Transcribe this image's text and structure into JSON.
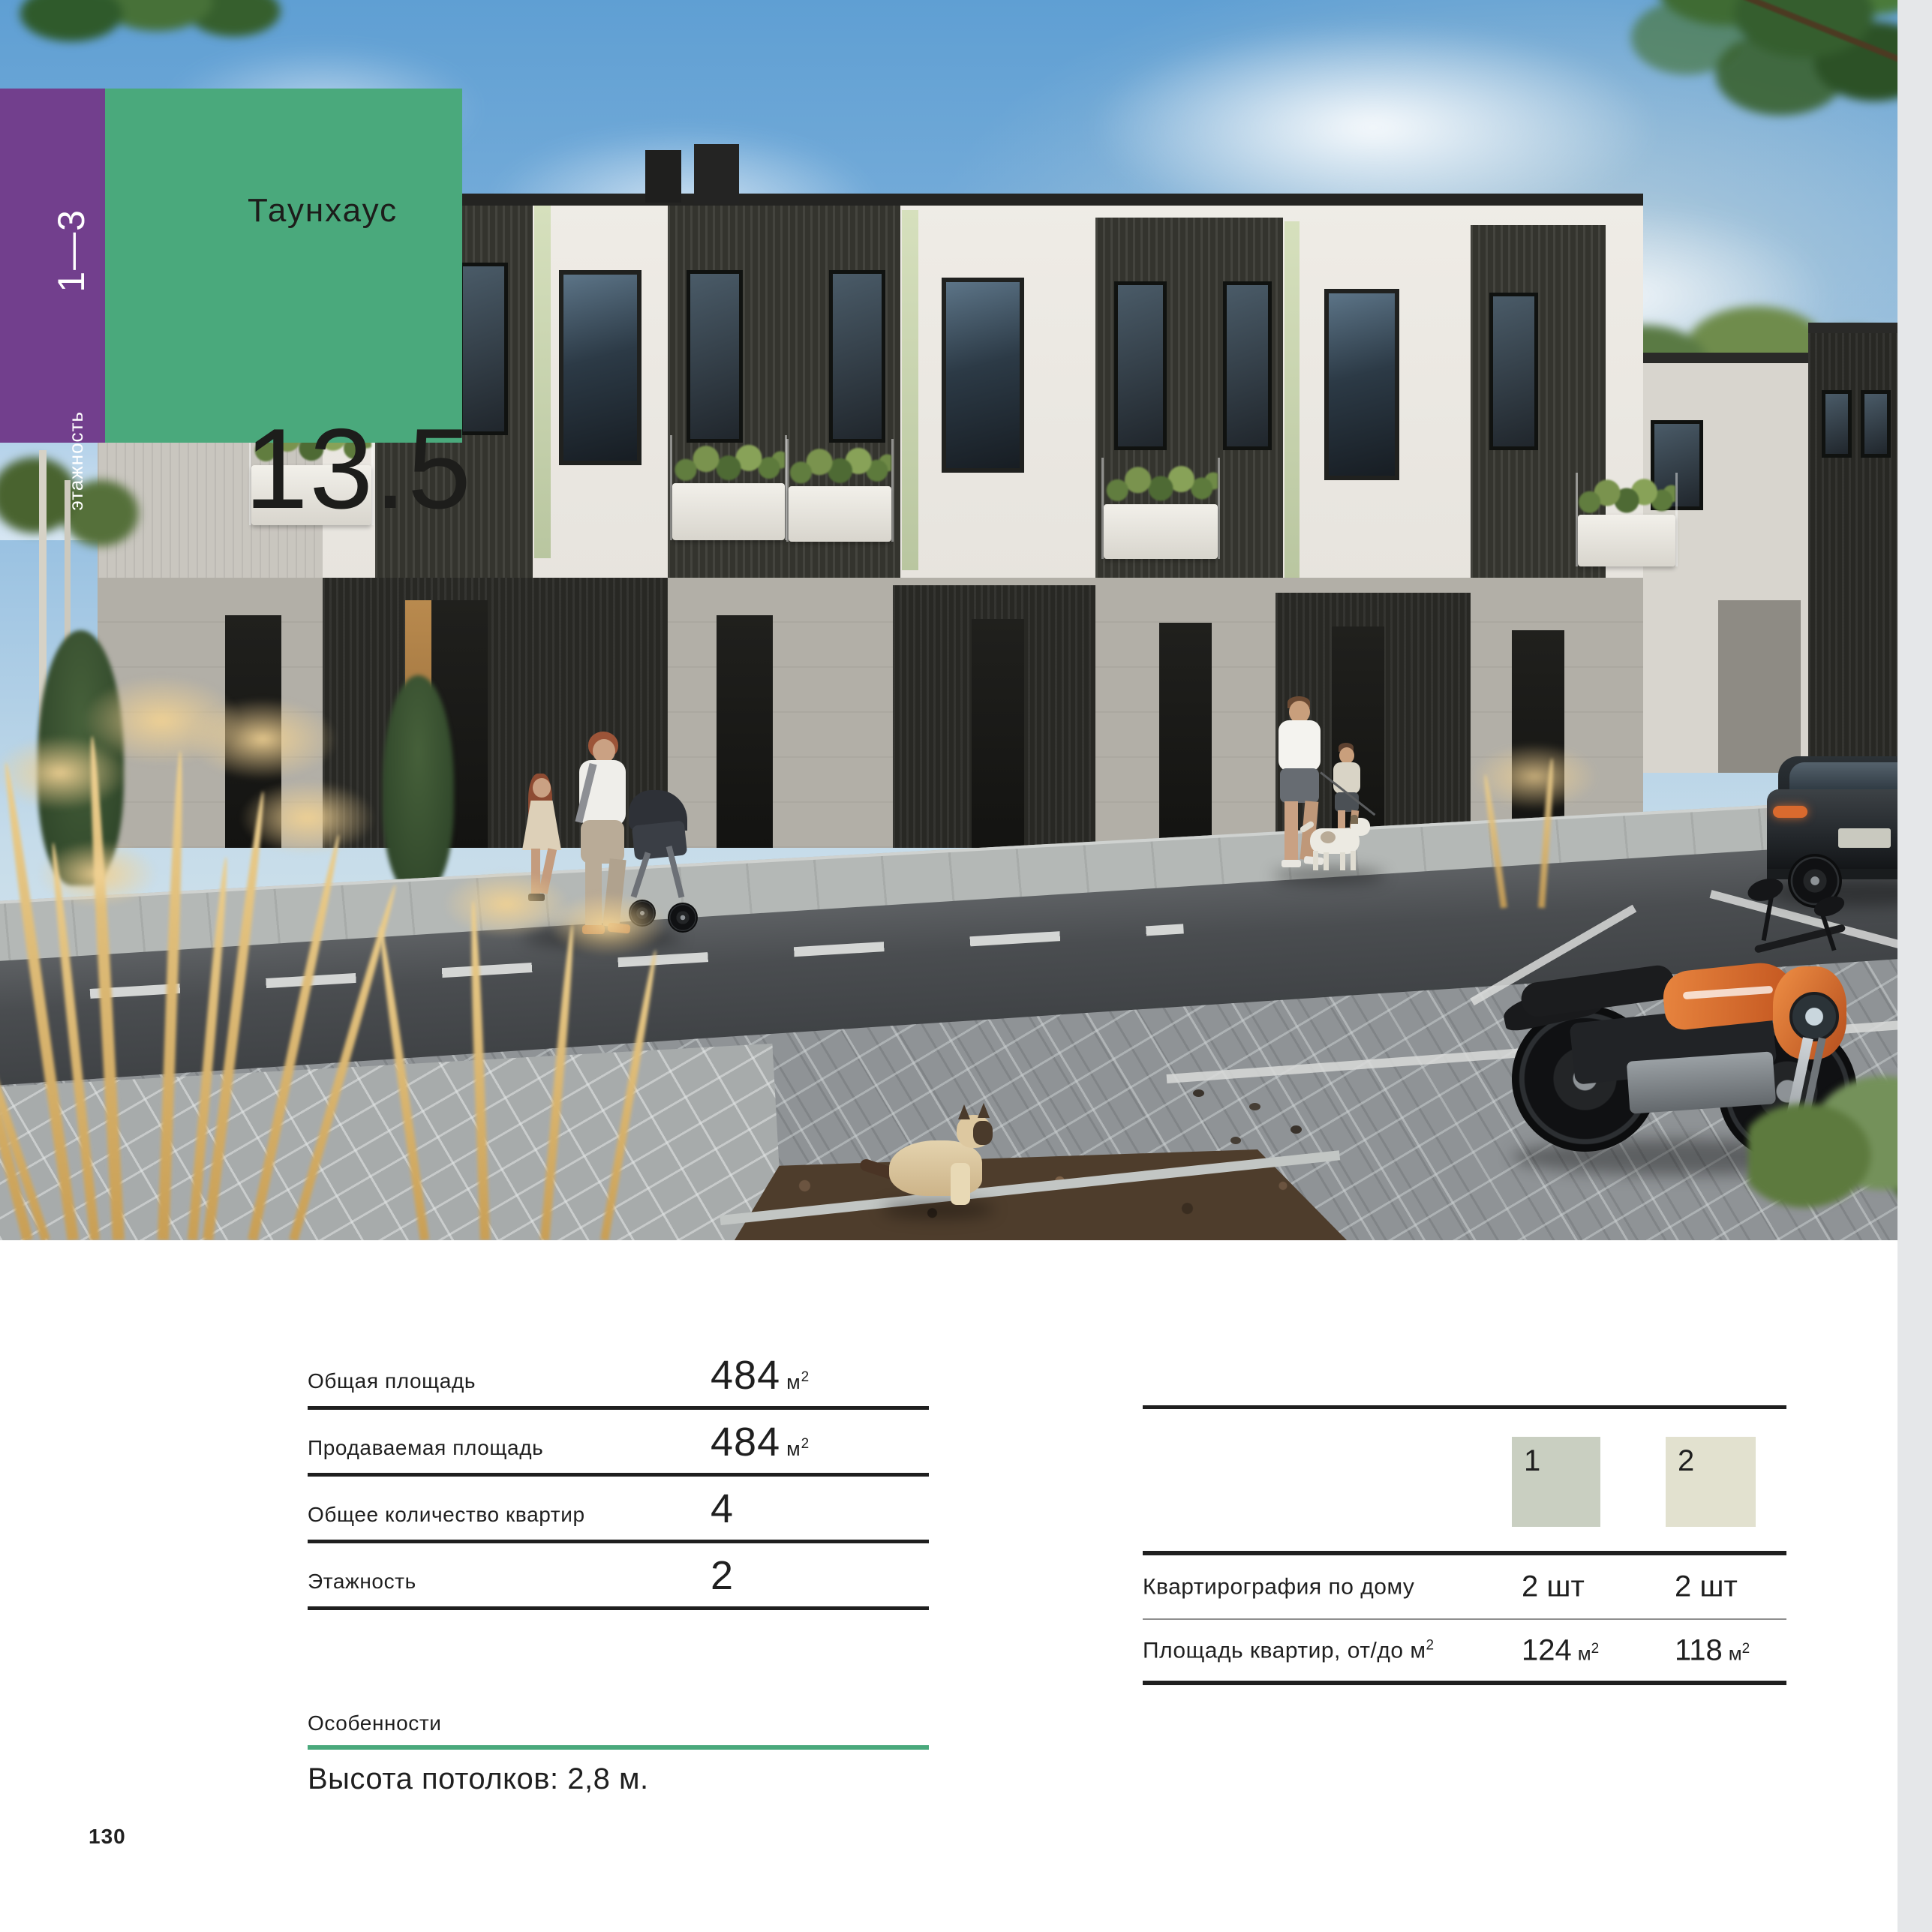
{
  "page": {
    "number": "130"
  },
  "colors": {
    "purple": "#723f8d",
    "green": "#4aa97c",
    "text": "#1f1f1f",
    "thin_line": "#8f8f8f",
    "side_strip": "#e5e7e9",
    "swatch_1": "#c9cfc1",
    "swatch_2": "#e2e1cf"
  },
  "header": {
    "floors_range": "1—3",
    "floors_axis_label": "этажность",
    "property_type": "Таунхаус",
    "building_number": "13.5"
  },
  "photo": {
    "description": "Визуализация двухэтажного таунхауса: улица с прохожими, мотоциклом, автомобилем, кошкой и золотистой травой"
  },
  "specs": {
    "rows": [
      {
        "label": "Общая площадь",
        "value": "484",
        "unit_base": "м",
        "unit_sup": "2"
      },
      {
        "label": "Продаваемая площадь",
        "value": "484",
        "unit_base": "м",
        "unit_sup": "2"
      },
      {
        "label": "Общее количество квартир",
        "value": "4",
        "unit_base": "",
        "unit_sup": ""
      },
      {
        "label": "Этажность",
        "value": "2",
        "unit_base": "",
        "unit_sup": ""
      }
    ]
  },
  "apartments": {
    "types": [
      {
        "id": "1"
      },
      {
        "id": "2"
      }
    ],
    "rows": [
      {
        "label_base": "Квартирография по дому",
        "label_sup": "",
        "values": [
          {
            "num": "2 шт",
            "unit_base": "",
            "unit_sup": ""
          },
          {
            "num": "2 шт",
            "unit_base": "",
            "unit_sup": ""
          }
        ]
      },
      {
        "label_base": "Площадь квартир, от/до м",
        "label_sup": "2",
        "values": [
          {
            "num": "124",
            "unit_base": "м",
            "unit_sup": "2"
          },
          {
            "num": "118",
            "unit_base": "м",
            "unit_sup": "2"
          }
        ]
      }
    ]
  },
  "features": {
    "title": "Особенности",
    "text": "Высота потолков: 2,8 м."
  }
}
